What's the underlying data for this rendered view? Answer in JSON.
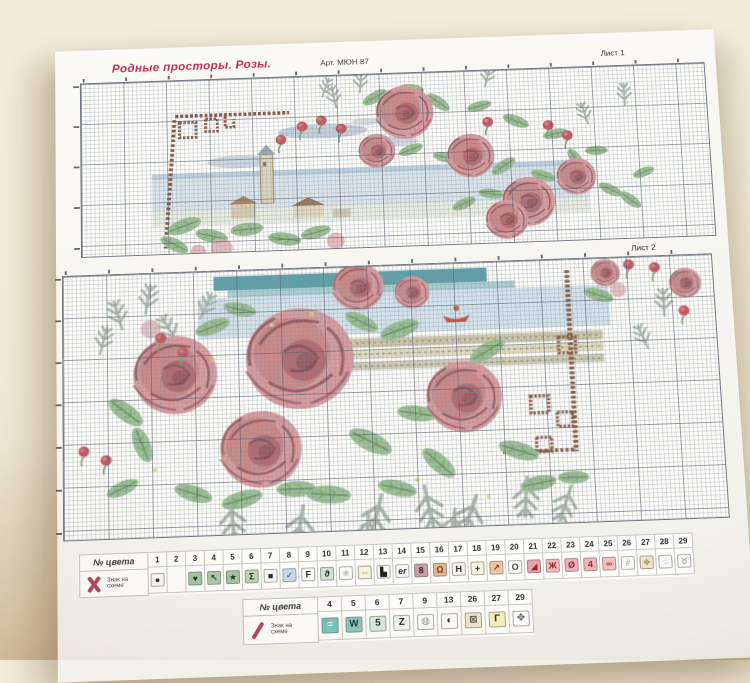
{
  "photo": {
    "background": "#f0ebd9",
    "table_shadow": "#c9b896"
  },
  "header": {
    "title": "Родные просторы. Розы.",
    "title_color": "#c03057",
    "art_no": "Арт. МЮН 87",
    "sheet1_label": "Лист 1",
    "sheet2_label": "Лист 2"
  },
  "legend_full_cross": {
    "col_header": "№ цвета",
    "row_header": "Знак на схеме",
    "marker_icon": "full-cross-x",
    "marker_color": "#b0455c",
    "columns": [
      {
        "num": "1",
        "sym": "●",
        "bg": "#f6f6f1",
        "fg": "#2b2b2b"
      },
      {
        "num": "2",
        "sym": "",
        "bg": "",
        "fg": ""
      },
      {
        "num": "3",
        "sym": "♥",
        "bg": "#a2c5a2",
        "fg": "#1f3524"
      },
      {
        "num": "4",
        "sym": "↖",
        "bg": "#a9cba9",
        "fg": "#1f3524"
      },
      {
        "num": "5",
        "sym": "★",
        "bg": "#a2c5a2",
        "fg": "#1f3524"
      },
      {
        "num": "6",
        "sym": "Σ",
        "bg": "#bdd6b4",
        "fg": "#23302a"
      },
      {
        "num": "7",
        "sym": "■",
        "bg": "#f8f8f4",
        "fg": "#2b2b2b"
      },
      {
        "num": "8",
        "sym": "✓",
        "bg": "#c5dcec",
        "fg": "#2b4a66"
      },
      {
        "num": "9",
        "sym": "F",
        "bg": "#fbfbf8",
        "fg": "#222222"
      },
      {
        "num": "10",
        "sym": "ϑ",
        "bg": "#d1e3d1",
        "fg": "#1d2b1d"
      },
      {
        "num": "11",
        "sym": "❀",
        "bg": "#fbfbf6",
        "fg": "#b7bcb7"
      },
      {
        "num": "12",
        "sym": "⇔",
        "bg": "#f4f2d8",
        "fg": "#8c8c59"
      },
      {
        "num": "13",
        "sym": "▙",
        "bg": "#fcfcfa",
        "fg": "#222222"
      },
      {
        "num": "14",
        "sym": "er",
        "bg": "#fcfcfa",
        "fg": "#333333",
        "it": true
      },
      {
        "num": "15",
        "sym": "8",
        "bg": "#c7a1a7",
        "fg": "#3a2328"
      },
      {
        "num": "16",
        "sym": "Ω",
        "bg": "#dfb990",
        "fg": "#7c3120"
      },
      {
        "num": "17",
        "sym": "H",
        "bg": "#f8f3ef",
        "fg": "#222222"
      },
      {
        "num": "18",
        "sym": "+",
        "bg": "#f6f3de",
        "fg": "#222222"
      },
      {
        "num": "19",
        "sym": "↗",
        "bg": "#f1c4a1",
        "fg": "#8c2b1b"
      },
      {
        "num": "20",
        "sym": "O",
        "bg": "#fdfdfb",
        "fg": "#444444"
      },
      {
        "num": "21",
        "sym": "◢",
        "bg": "#e9a3ab",
        "fg": "#8c2431"
      },
      {
        "num": "22",
        "sym": "Ж",
        "bg": "#f2babe",
        "fg": "#8c2431"
      },
      {
        "num": "23",
        "sym": "Ø",
        "bg": "#f0b1b9",
        "fg": "#8c2431"
      },
      {
        "num": "24",
        "sym": "4",
        "bg": "#f2b5b9",
        "fg": "#8c2431"
      },
      {
        "num": "25",
        "sym": "∞",
        "bg": "#f4c1bd",
        "fg": "#8c4a42"
      },
      {
        "num": "26",
        "sym": "#",
        "bg": "#fcfcfa",
        "fg": "#b0b0ab"
      },
      {
        "num": "27",
        "sym": "❖",
        "bg": "#f2e3c9",
        "fg": "#9b9b5b"
      },
      {
        "num": "28",
        "sym": "♧",
        "bg": "#fdfdfd",
        "fg": "#b7b7b3"
      },
      {
        "num": "29",
        "sym": "♉",
        "bg": "#fdfdfd",
        "fg": "#8b8b89"
      }
    ]
  },
  "legend_half_stitch": {
    "col_header": "№ цвета",
    "row_header": "Знак на схеме",
    "marker_icon": "half-stitch-slash",
    "marker_color": "#b0455c",
    "columns": [
      {
        "num": "4",
        "sym": "=",
        "bg": "#79c3bb",
        "fg": "#eaf6f2"
      },
      {
        "num": "5",
        "sym": "W",
        "bg": "#8ec8bf",
        "fg": "#1c3a3a"
      },
      {
        "num": "6",
        "sym": "5",
        "bg": "#d8ebd8",
        "fg": "#24333a"
      },
      {
        "num": "7",
        "sym": "Z",
        "bg": "#f1f5f1",
        "fg": "#222222"
      },
      {
        "num": "9",
        "sym": "◍",
        "bg": "#fcfcfa",
        "fg": "#8b9096"
      },
      {
        "num": "13",
        "sym": "◐",
        "bg": "#fcfcfa",
        "fg": "#222222"
      },
      {
        "num": "26",
        "sym": "⊠",
        "bg": "#efe7cb",
        "fg": "#56524b"
      },
      {
        "num": "27",
        "sym": "Γ",
        "bg": "#f6efbb",
        "fg": "#222222"
      },
      {
        "num": "29",
        "sym": "✥",
        "bg": "#fcfcfa",
        "fg": "#56585b"
      }
    ]
  }
}
